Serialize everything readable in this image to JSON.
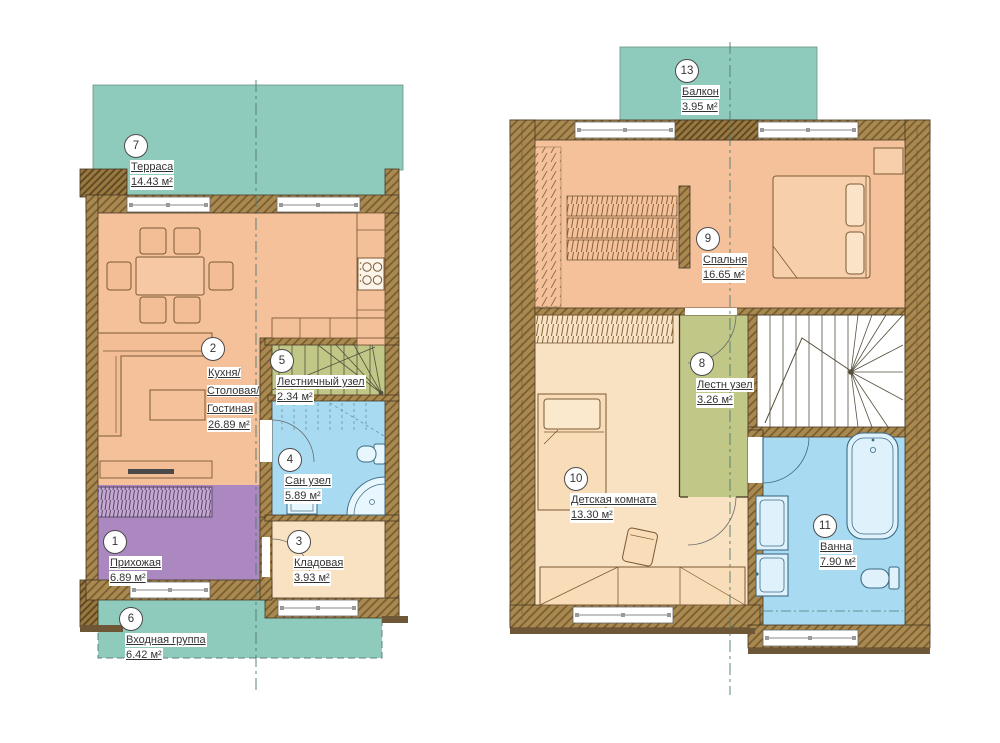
{
  "document": {
    "type": "floor-plan-drawing",
    "language": "ru"
  },
  "colors": {
    "terrace_teal": "#8fcbbd",
    "room_peach": "#f5c19b",
    "room_cream": "#f9e2c2",
    "hall_purple": "#ab88bf",
    "bath_blue": "#a8dbf2",
    "stair_olive": "#c1c887",
    "wall_brown": "#a8894f",
    "wall_hatch": "#77592e",
    "text": "#333333"
  },
  "plans": [
    {
      "id": "first-floor",
      "rooms": [
        {
          "number": "7",
          "name": "Терраса",
          "area": "14.43 м²"
        },
        {
          "number": "2",
          "name": "Кухня/ Столовая/ Гостиная",
          "area": "26.89 м²"
        },
        {
          "number": "5",
          "name": "Лестничный узел",
          "area": "2.34 м²"
        },
        {
          "number": "4",
          "name": "Сан узел",
          "area": "5.89 м²"
        },
        {
          "number": "3",
          "name": "Кладовая",
          "area": "3.93 м²"
        },
        {
          "number": "1",
          "name": "Прихожая",
          "area": "6.89 м²"
        },
        {
          "number": "6",
          "name": "Входная группа",
          "area": "6.42 м²"
        }
      ]
    },
    {
      "id": "second-floor",
      "rooms": [
        {
          "number": "13",
          "name": "Балкон",
          "area": "3.95 м²"
        },
        {
          "number": "9",
          "name": "Спальня",
          "area": "16.65 м²"
        },
        {
          "number": "8",
          "name": "Лестн узел",
          "area": "3.26 м²"
        },
        {
          "number": "10",
          "name": "Детская комната",
          "area": "13.30 м²"
        },
        {
          "number": "11",
          "name": "Ванна",
          "area": "7.90 м²"
        }
      ]
    }
  ]
}
